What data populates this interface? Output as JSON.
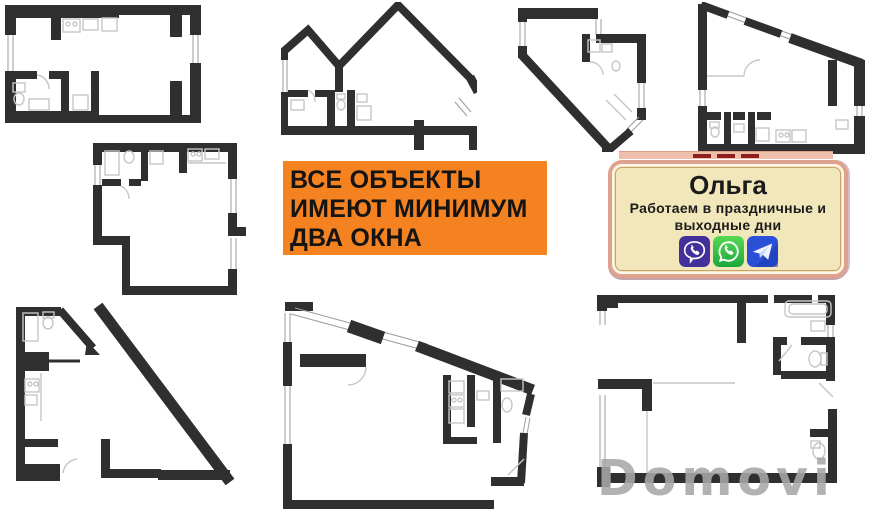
{
  "canvas": {
    "width": 888,
    "height": 512,
    "background": "#ffffff"
  },
  "banner": {
    "lines": [
      "ВСЕ ОБЪЕКТЫ",
      "ИМЕЮТ МИНИМУМ",
      "ДВА ОКНА"
    ],
    "bg_color": "#f58220",
    "text_color": "#141414"
  },
  "contact_card": {
    "name": "Ольга",
    "subtitle_lines": [
      "Работаем в праздничные и",
      "выходные дни"
    ],
    "bg_color": "#f2e7ba",
    "border_color": "#dfa28f",
    "text_color": "#1b1b1b",
    "icons": [
      {
        "name": "viber-icon",
        "color": "#44309a"
      },
      {
        "name": "whatsapp-icon",
        "color": "#2fc043"
      },
      {
        "name": "telegram-icon",
        "color": "#2b50d8"
      }
    ]
  },
  "watermark": {
    "text": "Domovi",
    "color": "#a8a8a8"
  },
  "floor_plans": {
    "count": 8,
    "wall_color": "#2f2f2f",
    "fixture_color": "#c6c6c6",
    "items": [
      "floor-plan-top-left",
      "floor-plan-top-middle",
      "floor-plan-top-center-right",
      "floor-plan-top-right",
      "floor-plan-middle-left",
      "floor-plan-bottom-left",
      "floor-plan-bottom-middle",
      "floor-plan-bottom-right"
    ]
  }
}
